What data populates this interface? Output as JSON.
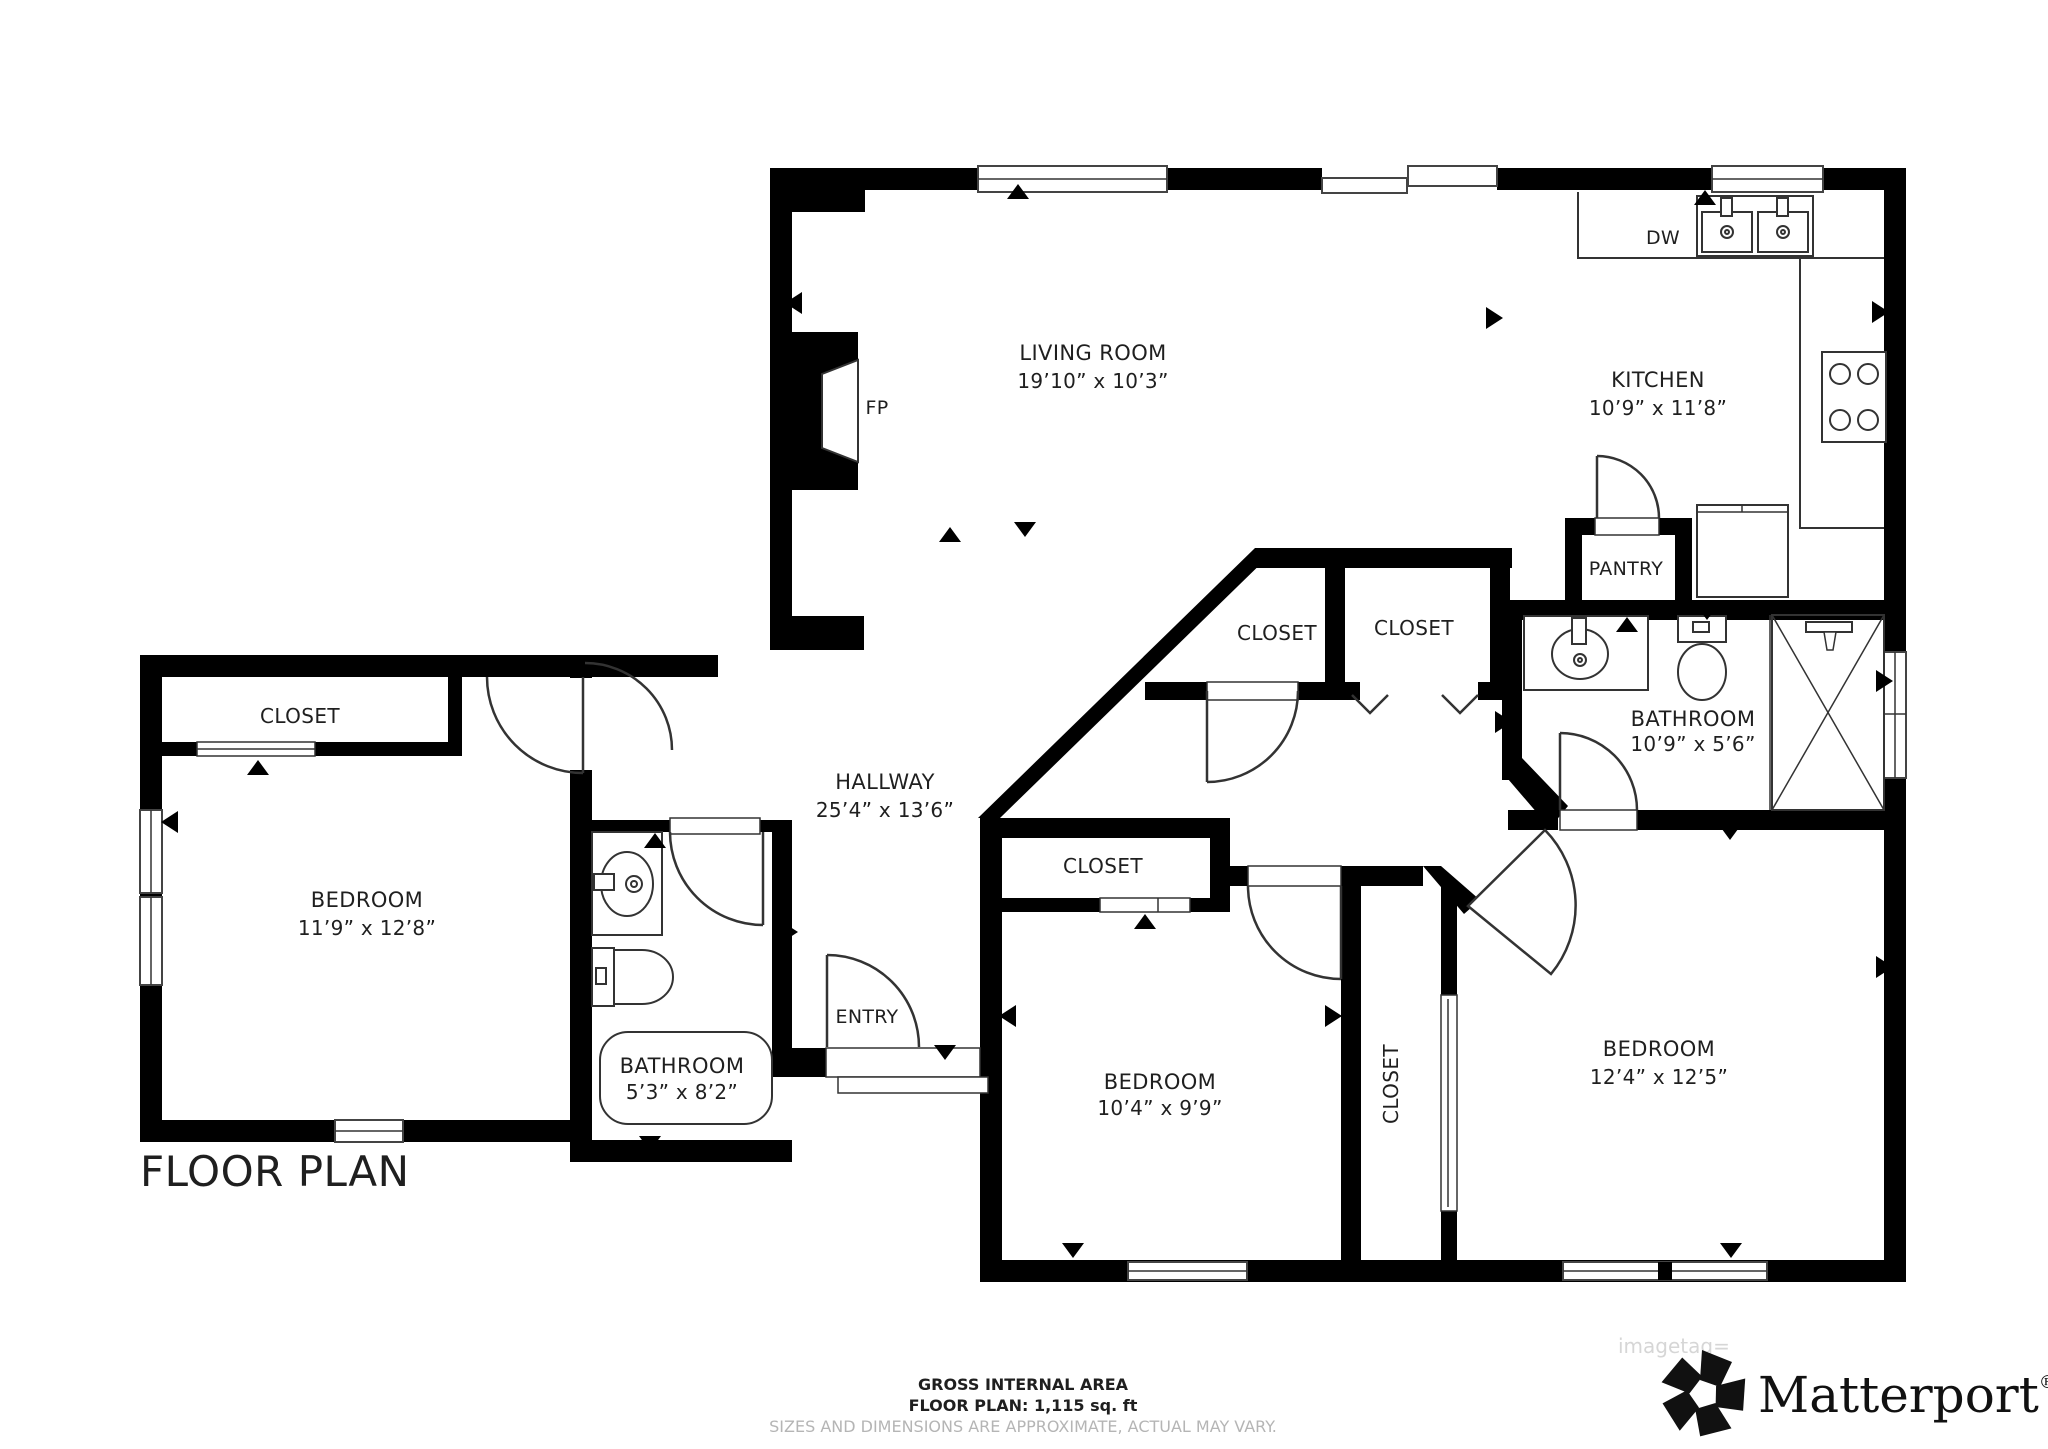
{
  "title": "FLOOR PLAN",
  "rooms": {
    "living": {
      "name": "LIVING ROOM",
      "dims": "19’10” x 10’3”"
    },
    "kitchen": {
      "name": "KITCHEN",
      "dims": "10’9” x 11’8”"
    },
    "bathroom_main": {
      "name": "BATHROOM",
      "dims": "10’9” x 5’6”"
    },
    "hallway": {
      "name": "HALLWAY",
      "dims": "25’4” x 13’6”"
    },
    "bedroom_left": {
      "name": "BEDROOM",
      "dims": "11’9” x 12’8”"
    },
    "bathroom_small": {
      "name": "BATHROOM",
      "dims": "5’3” x 8’2”"
    },
    "bedroom_middle": {
      "name": "BEDROOM",
      "dims": "10’4” x 9’9”"
    },
    "bedroom_right": {
      "name": "BEDROOM",
      "dims": "12’4” x 12’5”"
    }
  },
  "closets": {
    "bedroom_left": "CLOSET",
    "hall_angled": "CLOSET",
    "hall_square": "CLOSET",
    "bedroom_middle": "CLOSET",
    "between_bedrooms": "CLOSET"
  },
  "features": {
    "fireplace": "FP",
    "dishwasher": "DW",
    "pantry": "PANTRY",
    "entry": "ENTRY"
  },
  "footer": {
    "area_label": "GROSS INTERNAL AREA",
    "area_value": "FLOOR PLAN: 1,115 sq. ft",
    "disclaimer": "SIZES AND DIMENSIONS ARE APPROXIMATE, ACTUAL MAY VARY."
  },
  "watermark": "imagetag=",
  "brand": {
    "name": "Matterport",
    "registered": "®"
  },
  "colors": {
    "wall": "#000000",
    "line": "#333333",
    "label": "#1f1f1f",
    "footer_muted": "#b5b5b5",
    "watermark": "#d6d6d6"
  }
}
